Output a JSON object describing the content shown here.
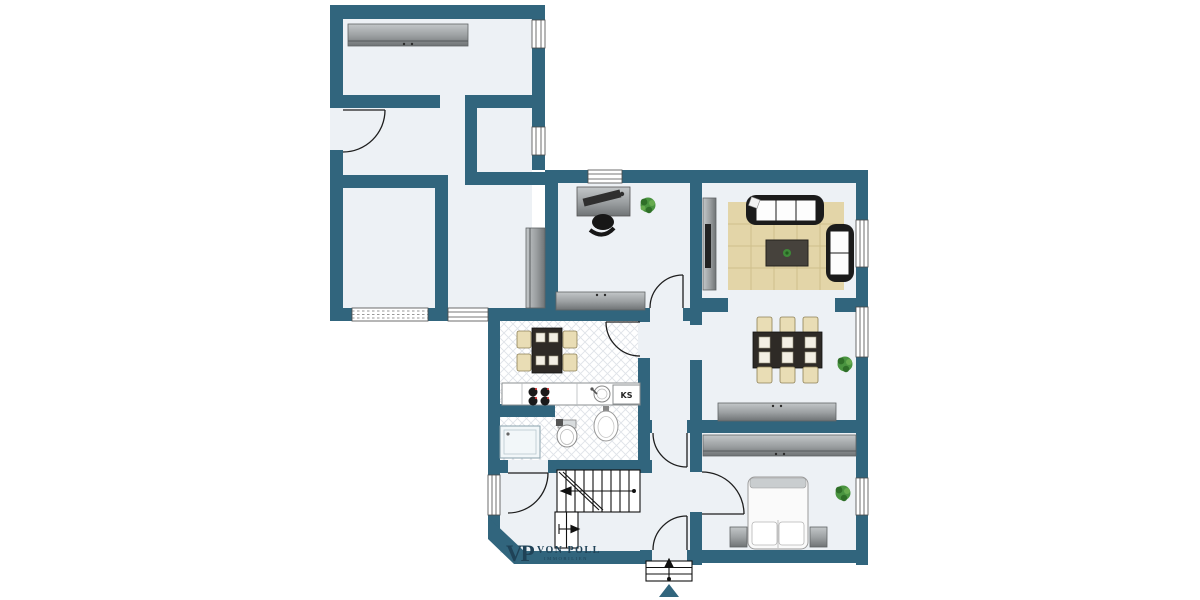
{
  "branding": {
    "logo_monogram": "VP",
    "logo_name": "VON POLL",
    "logo_sub": "IMMOBILIEN"
  },
  "labels": {
    "fridge": "KS"
  },
  "colors": {
    "wall": "#31657d",
    "floor": "#edf1f5",
    "outside": "#ffffff",
    "rug": "#e3d5a8",
    "rug_line": "#cfc08c",
    "furniture_gray_light": "#b9bdbf",
    "furniture_gray_dark": "#7e8284",
    "sofa_dark": "#1b1b1b",
    "chair_beige": "#e9ddb5",
    "table_dark": "#2e2a26",
    "plant_green": "#3e8a38",
    "tile_line": "#dfe3e8",
    "logo": "#1f4257"
  }
}
